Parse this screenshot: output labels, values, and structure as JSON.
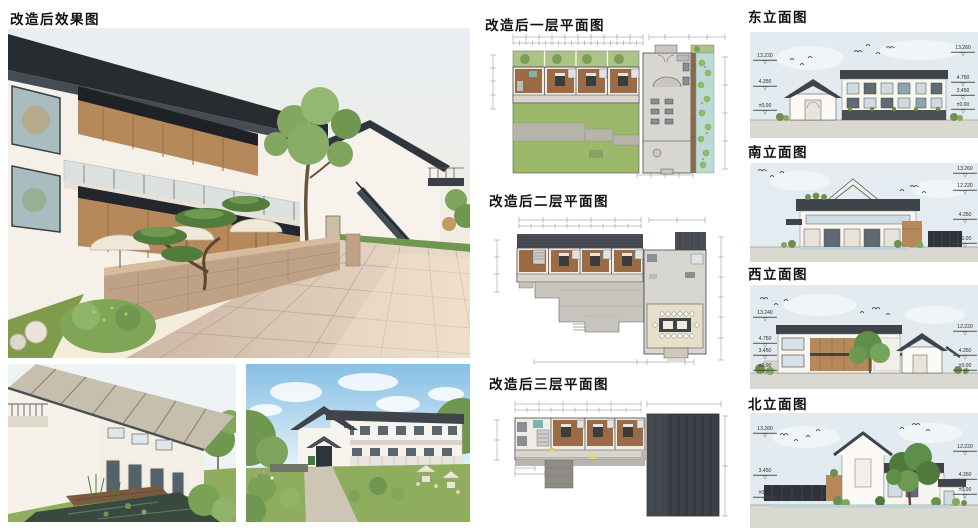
{
  "sections": {
    "renders": {
      "title": "改造后效果图"
    },
    "plans": [
      {
        "title": "改造后一层平面图"
      },
      {
        "title": "改造后二层平面图"
      },
      {
        "title": "改造后三层平面图"
      }
    ],
    "elevations": [
      {
        "title": "东立面图",
        "left_levels": [
          "13.220",
          "4.350",
          "±0.00"
        ],
        "right_levels": [
          "13.260",
          "4.750",
          "3.450",
          "±0.00"
        ]
      },
      {
        "title": "南立面图",
        "left_levels": [],
        "right_levels": [
          "13.260",
          "12.220",
          "4.350",
          "±0.00"
        ]
      },
      {
        "title": "西立面图",
        "left_levels": [
          "13.240",
          "4.750",
          "3.450",
          "±0.00"
        ],
        "right_levels": [
          "12.220",
          "4.350",
          "±0.00"
        ]
      },
      {
        "title": "北立面图",
        "left_levels": [
          "13.260",
          "3.450",
          "±0.00"
        ],
        "right_levels": [
          "12.220",
          "4.350",
          "±0.00"
        ]
      }
    ]
  },
  "icons": {
    "level_triangle": "▽"
  },
  "colors": {
    "roof_dark": "#3f444b",
    "wood": "#b5895a",
    "lawn": "#8fae5d",
    "plan_green": "#9cb86b",
    "pond": "#bcd9d3",
    "sky": "#e3ebf1"
  }
}
